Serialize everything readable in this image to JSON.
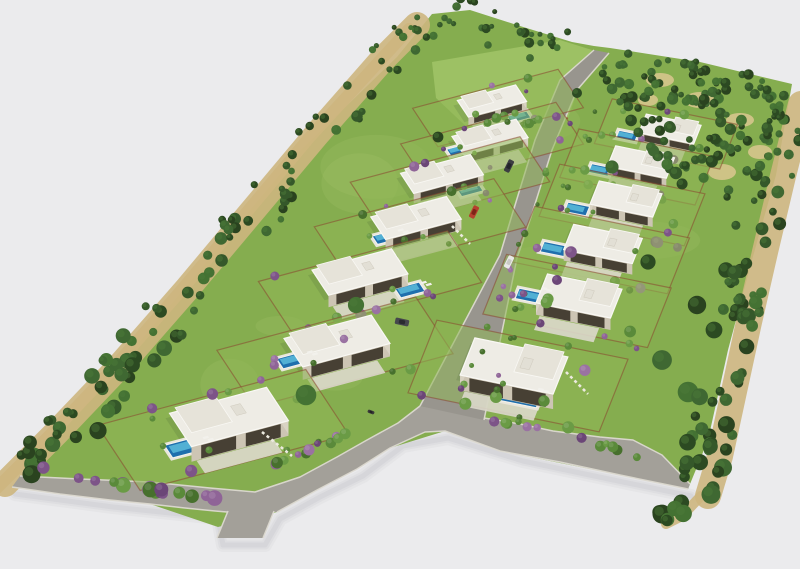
{
  "meta": {
    "type": "3d-aerial-site-plan-render",
    "description": "Aerial axonometric 3D render of a wedge-shaped residential development: 13 white flat-roof villas with blue pools and lawns along a central road, perimeter tree belts, rust garden walls, purple bougainvillea, gray asphalt roads"
  },
  "canvas": {
    "w": 800,
    "h": 569
  },
  "palette": {
    "bg": "#ebebed",
    "lawn": "#85ad4f",
    "plot_lawn": "#8fb755",
    "lawn_light": "#b2d077",
    "field": "#9dc164",
    "road": "#a3a099",
    "road_dark": "#98958e",
    "curb": "#dcd9d0",
    "dirt": "#cdb67e",
    "dirt_light": "#dac78f",
    "fence_rust": "#8a4530",
    "roof_white": "#eeece5",
    "roof_wing": "#e6e3d9",
    "parapet": "#f9f8f4",
    "wall_shade": "#cdc5b4",
    "wall_side": "#d9d3c3",
    "glass_dark": "#474034",
    "terrace": "#dcd8cb",
    "pool_deck": "#e9e6db",
    "water_deep": "#1f6fad",
    "water_mid": "#2e86bd",
    "water_light": "#5fc0dd",
    "shadow": "#b4b4bc",
    "house_shadow": "#3f5530",
    "tree_greens": [
      "#2c4a22",
      "#35582a",
      "#3f6832",
      "#2a431f",
      "#447233"
    ],
    "tree_highlight": "#4e7d3a",
    "bush_greens": [
      "#5a8a3a",
      "#47702d",
      "#6a9b45"
    ],
    "purples": [
      "#7d5488",
      "#8f6497",
      "#6b4677",
      "#9a72a2"
    ],
    "stone": "#eceadf"
  },
  "axes": {
    "left": {
      "u": [
        0.97,
        -0.26
      ],
      "v": [
        0.55,
        0.835
      ]
    },
    "right": {
      "u": [
        0.98,
        0.2
      ],
      "v": [
        -0.37,
        0.93
      ]
    }
  },
  "lawn_outline": [
    [
      12,
      487
    ],
    [
      95,
      395
    ],
    [
      185,
      288
    ],
    [
      298,
      153
    ],
    [
      397,
      57
    ],
    [
      432,
      14
    ],
    [
      470,
      10
    ],
    [
      520,
      26
    ],
    [
      572,
      42
    ],
    [
      594,
      46
    ],
    [
      610,
      48
    ],
    [
      700,
      62
    ],
    [
      792,
      84
    ],
    [
      776,
      175
    ],
    [
      752,
      260
    ],
    [
      728,
      350
    ],
    [
      708,
      440
    ],
    [
      688,
      489
    ],
    [
      600,
      471
    ],
    [
      500,
      451
    ],
    [
      445,
      431
    ],
    [
      390,
      448
    ],
    [
      317,
      490
    ],
    [
      277,
      512
    ],
    [
      218,
      527
    ],
    [
      150,
      504
    ],
    [
      60,
      494
    ]
  ],
  "field": {
    "poly": [
      [
        432,
        62
      ],
      [
        560,
        40
      ],
      [
        592,
        50
      ],
      [
        568,
        118
      ],
      [
        472,
        132
      ],
      [
        436,
        98
      ]
    ],
    "fence": [
      [
        472,
        132
      ],
      [
        568,
        118
      ]
    ]
  },
  "roads": {
    "perimeter_outer": [
      [
        12,
        487
      ],
      [
        60,
        494
      ],
      [
        110,
        500
      ],
      [
        150,
        504
      ],
      [
        185,
        508
      ],
      [
        215,
        511
      ],
      [
        227,
        512
      ],
      [
        277,
        512
      ],
      [
        317,
        490
      ],
      [
        357,
        469
      ],
      [
        390,
        448
      ],
      [
        425,
        432
      ],
      [
        445,
        431
      ],
      [
        500,
        451
      ],
      [
        560,
        462
      ],
      [
        620,
        475
      ],
      [
        688,
        489
      ]
    ],
    "perimeter_inner": [
      [
        20,
        476
      ],
      [
        80,
        479
      ],
      [
        150,
        482
      ],
      [
        210,
        488
      ],
      [
        255,
        492
      ],
      [
        300,
        477
      ],
      [
        337,
        457
      ],
      [
        367,
        440
      ],
      [
        398,
        423
      ],
      [
        420,
        406
      ]
    ],
    "perimeter_inner_right": [
      [
        484,
        418
      ],
      [
        520,
        424
      ],
      [
        553,
        431
      ],
      [
        600,
        437
      ],
      [
        633,
        440
      ],
      [
        662,
        455
      ],
      [
        690,
        484
      ]
    ],
    "central_left": [
      [
        594,
        50
      ],
      [
        560,
        80
      ],
      [
        535,
        140
      ],
      [
        512,
        215
      ],
      [
        500,
        255
      ],
      [
        420,
        406
      ]
    ],
    "central_right": [
      [
        609,
        53
      ],
      [
        577,
        90
      ],
      [
        552,
        150
      ],
      [
        530,
        220
      ],
      [
        517,
        258
      ],
      [
        484,
        420
      ]
    ],
    "stub": [
      [
        228,
        510
      ],
      [
        274,
        511
      ],
      [
        263,
        538
      ],
      [
        217,
        538
      ]
    ],
    "stub_curbs": [
      [
        [
          228,
          511
        ],
        [
          217,
          538
        ]
      ],
      [
        [
          274,
          511
        ],
        [
          263,
          538
        ]
      ]
    ]
  },
  "ground_shadow": [
    [
      12,
      489
    ],
    [
      110,
      502
    ],
    [
      215,
      513
    ],
    [
      220,
      540
    ],
    [
      262,
      540
    ],
    [
      277,
      514
    ],
    [
      317,
      492
    ],
    [
      360,
      471
    ],
    [
      400,
      441
    ],
    [
      445,
      433
    ],
    [
      520,
      456
    ],
    [
      620,
      477
    ],
    [
      688,
      491
    ]
  ],
  "tree_bands": [
    {
      "id": "left-belt",
      "pts": [
        [
          18,
          477
        ],
        [
          70,
          425
        ],
        [
          130,
          362
        ],
        [
          200,
          282
        ],
        [
          262,
          208
        ],
        [
          330,
          127
        ],
        [
          395,
          53
        ],
        [
          430,
          18
        ]
      ],
      "w": 44,
      "n": 98,
      "seed": 101
    },
    {
      "id": "top-belt",
      "pts": [
        [
          432,
          18
        ],
        [
          468,
          12
        ],
        [
          520,
          27
        ],
        [
          568,
          40
        ]
      ],
      "w": 26,
      "n": 26,
      "seed": 102
    },
    {
      "id": "right-belt",
      "pts": [
        [
          788,
          100
        ],
        [
          770,
          172
        ],
        [
          752,
          248
        ],
        [
          736,
          318
        ],
        [
          720,
          392
        ],
        [
          707,
          452
        ],
        [
          695,
          492
        ]
      ],
      "w": 42,
      "n": 74,
      "seed": 103
    },
    {
      "id": "bottom-tail",
      "pts": [
        [
          695,
          492
        ],
        [
          676,
          512
        ],
        [
          660,
          520
        ]
      ],
      "w": 14,
      "n": 7,
      "seed": 104
    }
  ],
  "woods": {
    "poly": [
      [
        608,
        48
      ],
      [
        700,
        62
      ],
      [
        793,
        84
      ],
      [
        772,
        180
      ],
      [
        700,
        210
      ],
      [
        642,
        140
      ],
      [
        600,
        70
      ]
    ],
    "n": 135,
    "seed": 105
  },
  "dirt_strips": [
    {
      "pts": [
        [
          18,
          477
        ],
        [
          70,
          425
        ],
        [
          130,
          362
        ],
        [
          200,
          282
        ],
        [
          262,
          208
        ],
        [
          330,
          127
        ],
        [
          395,
          53
        ],
        [
          430,
          18
        ]
      ],
      "dx": -13,
      "dy": 7,
      "w": 26
    },
    {
      "pts": [
        [
          18,
          477
        ],
        [
          70,
          425
        ],
        [
          130,
          362
        ],
        [
          200,
          282
        ],
        [
          330,
          127
        ],
        [
          430,
          18
        ]
      ],
      "dx": -21,
      "dy": 11,
      "w": 12
    },
    {
      "pts": [
        [
          788,
          100
        ],
        [
          770,
          172
        ],
        [
          752,
          248
        ],
        [
          736,
          318
        ],
        [
          720,
          392
        ],
        [
          707,
          452
        ],
        [
          695,
          492
        ]
      ],
      "dx": 13,
      "dy": 4,
      "w": 26
    },
    {
      "pts": [
        [
          695,
          492
        ],
        [
          676,
          512
        ],
        [
          660,
          520
        ]
      ],
      "dx": 6,
      "dy": 4,
      "w": 10
    }
  ],
  "dirt_patches": [
    [
      660,
      80,
      14,
      7
    ],
    [
      700,
      100,
      16,
      8
    ],
    [
      740,
      120,
      14,
      7
    ],
    [
      760,
      152,
      12,
      7
    ],
    [
      680,
      140,
      13,
      7
    ],
    [
      722,
      172,
      14,
      8
    ],
    [
      648,
      100,
      10,
      6
    ]
  ],
  "bush_rows": [
    {
      "pts": [
        [
          40,
          469
        ],
        [
          78,
          476
        ],
        [
          116,
          484
        ],
        [
          154,
          490
        ],
        [
          192,
          496
        ],
        [
          222,
          499
        ]
      ],
      "n": 18,
      "purple": 0.75,
      "r0": 4,
      "r1": 8,
      "seed": 201
    },
    {
      "pts": [
        [
          255,
          474
        ],
        [
          288,
          459
        ],
        [
          320,
          444
        ],
        [
          352,
          430
        ],
        [
          383,
          417
        ]
      ],
      "n": 12,
      "purple": 0.5,
      "r0": 3,
      "r1": 6,
      "seed": 202
    },
    {
      "pts": [
        [
          455,
          410
        ],
        [
          492,
          418
        ],
        [
          530,
          427
        ],
        [
          568,
          436
        ],
        [
          606,
          446
        ],
        [
          640,
          455
        ]
      ],
      "n": 14,
      "purple": 0.5,
      "r0": 3,
      "r1": 5.5,
      "seed": 203
    },
    {
      "pts": [
        [
          586,
          82
        ],
        [
          566,
          128
        ],
        [
          546,
          175
        ],
        [
          528,
          222
        ],
        [
          512,
          262
        ],
        [
          495,
          310
        ],
        [
          478,
          356
        ],
        [
          462,
          392
        ]
      ],
      "n": 16,
      "purple": 0.4,
      "r0": 2.2,
      "r1": 4,
      "seed": 204
    },
    {
      "pts": [
        [
          603,
          98
        ],
        [
          584,
          142
        ],
        [
          564,
          190
        ],
        [
          546,
          234
        ],
        [
          530,
          268
        ],
        [
          520,
          302
        ],
        [
          510,
          344
        ],
        [
          500,
          384
        ]
      ],
      "n": 14,
      "purple": 0.4,
      "r0": 2.2,
      "r1": 4,
      "seed": 205
    },
    {
      "pts": [
        [
          448,
          104
        ],
        [
          486,
          117
        ],
        [
          524,
          123
        ],
        [
          556,
          116
        ]
      ],
      "n": 8,
      "purple": 0.15,
      "r0": 3,
      "r1": 5,
      "seed": 206
    }
  ],
  "single_trees": [
    [
      612,
      167,
      7
    ],
    [
      648,
      262,
      7
    ],
    [
      697,
      305,
      8
    ],
    [
      662,
      360,
      8
    ],
    [
      577,
      93,
      6
    ],
    [
      356,
      305,
      7
    ],
    [
      306,
      395,
      8
    ],
    [
      438,
      137,
      6
    ],
    [
      726,
      270,
      7
    ],
    [
      714,
      330,
      7
    ],
    [
      688,
      392,
      8
    ],
    [
      530,
      58,
      5
    ],
    [
      488,
      45,
      5
    ]
  ],
  "villas": [
    {
      "id": "L1",
      "col": "left",
      "cx": 492,
      "cy": 101,
      "w": 60,
      "d": 20,
      "h": 8,
      "pool": {
        "dx": 27,
        "dy": 16,
        "w": 20,
        "d": 8
      },
      "plot": {
        "dx": 6,
        "dy": 7,
        "w": 150,
        "d": 46
      },
      "seed": 11
    },
    {
      "id": "L2",
      "col": "left",
      "cx": 490,
      "cy": 137,
      "w": 66,
      "d": 22,
      "h": 9,
      "pool": {
        "dx": -31,
        "dy": 13,
        "w": 21,
        "d": 8
      },
      "plot": {
        "dx": 2,
        "dy": 7,
        "w": 160,
        "d": 50
      },
      "seed": 12
    },
    {
      "id": "L3",
      "col": "left",
      "cx": 442,
      "cy": 174,
      "w": 72,
      "d": 24,
      "h": 10,
      "pool": {
        "dx": 28,
        "dy": 16,
        "w": 22,
        "d": 9
      },
      "plot": {
        "dx": 8,
        "dy": 8,
        "w": 175,
        "d": 54
      },
      "seed": 13
    },
    {
      "id": "L4",
      "col": "left",
      "cx": 416,
      "cy": 218,
      "w": 78,
      "d": 27,
      "h": 11,
      "pool": {
        "dx": -29,
        "dy": 19,
        "w": 25,
        "d": 10
      },
      "plot": {
        "dx": 4,
        "dy": 9,
        "w": 185,
        "d": 58
      },
      "seed": 14
    },
    {
      "id": "L5",
      "col": "left",
      "cx": 360,
      "cy": 272,
      "w": 82,
      "d": 30,
      "h": 12,
      "pool": {
        "dx": 50,
        "dy": 18,
        "w": 25,
        "d": 11
      },
      "plot": {
        "dx": 10,
        "dy": 10,
        "w": 195,
        "d": 62
      },
      "seed": 15
    },
    {
      "id": "L6",
      "col": "left",
      "cx": 337,
      "cy": 341,
      "w": 90,
      "d": 34,
      "h": 13,
      "pool": {
        "dx": -43,
        "dy": 19,
        "w": 29,
        "d": 12
      },
      "plot": {
        "dx": -2,
        "dy": 11,
        "w": 205,
        "d": 68
      },
      "seed": 16
    },
    {
      "id": "L7",
      "col": "left",
      "cx": 229,
      "cy": 417,
      "w": 100,
      "d": 40,
      "h": 15,
      "pool": {
        "dx": -43,
        "dy": 30,
        "w": 36,
        "d": 15
      },
      "plot": {
        "dx": -6,
        "dy": 13,
        "w": 215,
        "d": 78
      },
      "seed": 17
    },
    {
      "id": "R1",
      "col": "right",
      "cx": 670,
      "cy": 129,
      "w": 56,
      "d": 20,
      "h": 8,
      "pool": {
        "dx": -43,
        "dy": 7,
        "w": 19,
        "d": 8
      },
      "plot": {
        "dx": -4,
        "dy": 5,
        "w": 128,
        "d": 48
      },
      "seed": 21
    },
    {
      "id": "R2",
      "col": "right",
      "cx": 641,
      "cy": 162,
      "w": 60,
      "d": 22,
      "h": 9,
      "pool": {
        "dx": -41,
        "dy": 8,
        "w": 20,
        "d": 9
      },
      "plot": {
        "dx": -4,
        "dy": 5,
        "w": 138,
        "d": 52
      },
      "seed": 22
    },
    {
      "id": "R3",
      "col": "right",
      "cx": 626,
      "cy": 199,
      "w": 64,
      "d": 25,
      "h": 10,
      "pool": {
        "dx": -49,
        "dy": 10,
        "w": 22,
        "d": 10
      },
      "plot": {
        "dx": -4,
        "dy": 6,
        "w": 148,
        "d": 56
      },
      "seed": 23
    },
    {
      "id": "R4",
      "col": "right",
      "cx": 603,
      "cy": 244,
      "w": 70,
      "d": 27,
      "h": 11,
      "pool": {
        "dx": -49,
        "dy": 5,
        "w": 24,
        "d": 11
      },
      "plot": {
        "dx": -2,
        "dy": 6,
        "w": 158,
        "d": 60
      },
      "seed": 24
    },
    {
      "id": "R5",
      "col": "right",
      "cx": 579,
      "cy": 296,
      "w": 76,
      "d": 31,
      "h": 12,
      "pool": {
        "dx": -49,
        "dy": 0,
        "w": 26,
        "d": 11
      },
      "plot": {
        "dx": -2,
        "dy": 5,
        "w": 168,
        "d": 64
      },
      "seed": 25
    },
    {
      "id": "R6",
      "col": "right",
      "cx": 514,
      "cy": 366,
      "w": 95,
      "d": 40,
      "h": 15,
      "pool": {
        "dx": 6,
        "dy": 32,
        "w": 38,
        "d": 13
      },
      "plot": {
        "dx": 4,
        "dy": 10,
        "w": 195,
        "d": 78
      },
      "seed": 26
    }
  ],
  "stone_paths": [
    {
      "from": [
        262,
        432
      ],
      "to": [
        292,
        456
      ]
    },
    {
      "from": [
        566,
        372
      ],
      "to": [
        588,
        394
      ]
    },
    {
      "from": [
        452,
        226
      ],
      "to": [
        470,
        244
      ]
    }
  ],
  "cars": [
    {
      "x": 509,
      "y": 166,
      "w": 13,
      "h": 6,
      "a": 116,
      "body": "#3c3d42",
      "top": "#23242a"
    },
    {
      "x": 474,
      "y": 212,
      "w": 13,
      "h": 6,
      "a": 116,
      "body": "#b5402e",
      "top": "#7e2417"
    },
    {
      "x": 509,
      "y": 262,
      "w": 13,
      "h": 6,
      "a": 116,
      "body": "#e9e9e7",
      "top": "#c9c9c5"
    },
    {
      "x": 402,
      "y": 322,
      "w": 14,
      "h": 6.5,
      "a": 12,
      "body": "#46474d",
      "top": "#2a2b30"
    },
    {
      "x": 371,
      "y": 412,
      "w": 7,
      "h": 3.2,
      "a": 20,
      "body": "#3a3a3a",
      "top": "#222222"
    }
  ],
  "lawn_patch_seed": 301
}
